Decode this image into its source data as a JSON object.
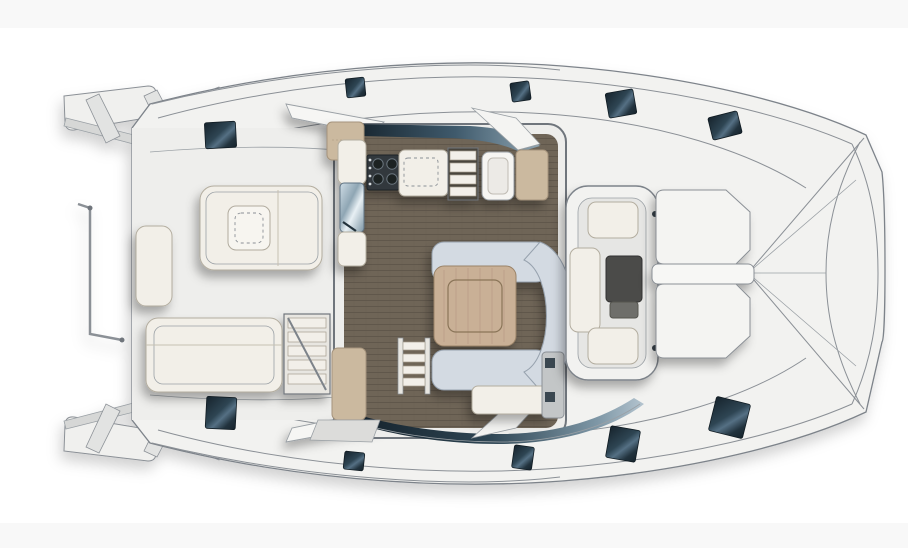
{
  "drawing": {
    "kind": "catamaran-deck-floor-plan",
    "view": "top-down"
  },
  "colors": {
    "background": "#ffffff",
    "band": "#f8f8f8",
    "hull_fill": "#f2f2f0",
    "hull_outline": "#7d838a",
    "deck": "#ededeb",
    "floor_wood": "#6f6557",
    "floor_plank_line": "#5e5549",
    "sofa": "#d3dae2",
    "sofa_edge": "#97a2ae",
    "table_wood": "#c9b096",
    "table_wood_line": "#8a7459",
    "cushion": "#f2efe8",
    "cushion_edge": "#b3ad9f",
    "tan_cabinet": "#cbb99f",
    "stove": "#31373c",
    "metal": "#a9bcc9",
    "glass_dark": "#16232c",
    "glass_mid": "#3f5a6c",
    "glass_light": "#8fa5b2",
    "hatch_dark": "#16232c",
    "hatch_light": "#557084",
    "dark_table": "#4b4b49"
  },
  "hatches": {
    "top": [
      [
        205,
        122,
        31,
        26,
        -3
      ],
      [
        346,
        78,
        19,
        19,
        -6
      ],
      [
        511,
        82,
        19,
        19,
        -8
      ],
      [
        607,
        91,
        28,
        25,
        -10
      ],
      [
        710,
        114,
        30,
        23,
        -14
      ]
    ],
    "bottom": [
      [
        206,
        397,
        30,
        32,
        3
      ],
      [
        344,
        452,
        20,
        18,
        6
      ],
      [
        513,
        446,
        20,
        23,
        8
      ],
      [
        608,
        428,
        30,
        32,
        10
      ],
      [
        712,
        400,
        35,
        35,
        14
      ]
    ]
  },
  "transom_steps": {
    "top": [
      "86,100 99,94 120,136 106,143",
      "144,96 157,90 178,130 164,137",
      "206,92 219,87 240,124 226,131"
    ],
    "bottom": [
      "86,447 99,453 120,411 106,404",
      "144,451 157,457 178,417 164,410",
      "206,455 219,460 240,423 226,416"
    ]
  }
}
